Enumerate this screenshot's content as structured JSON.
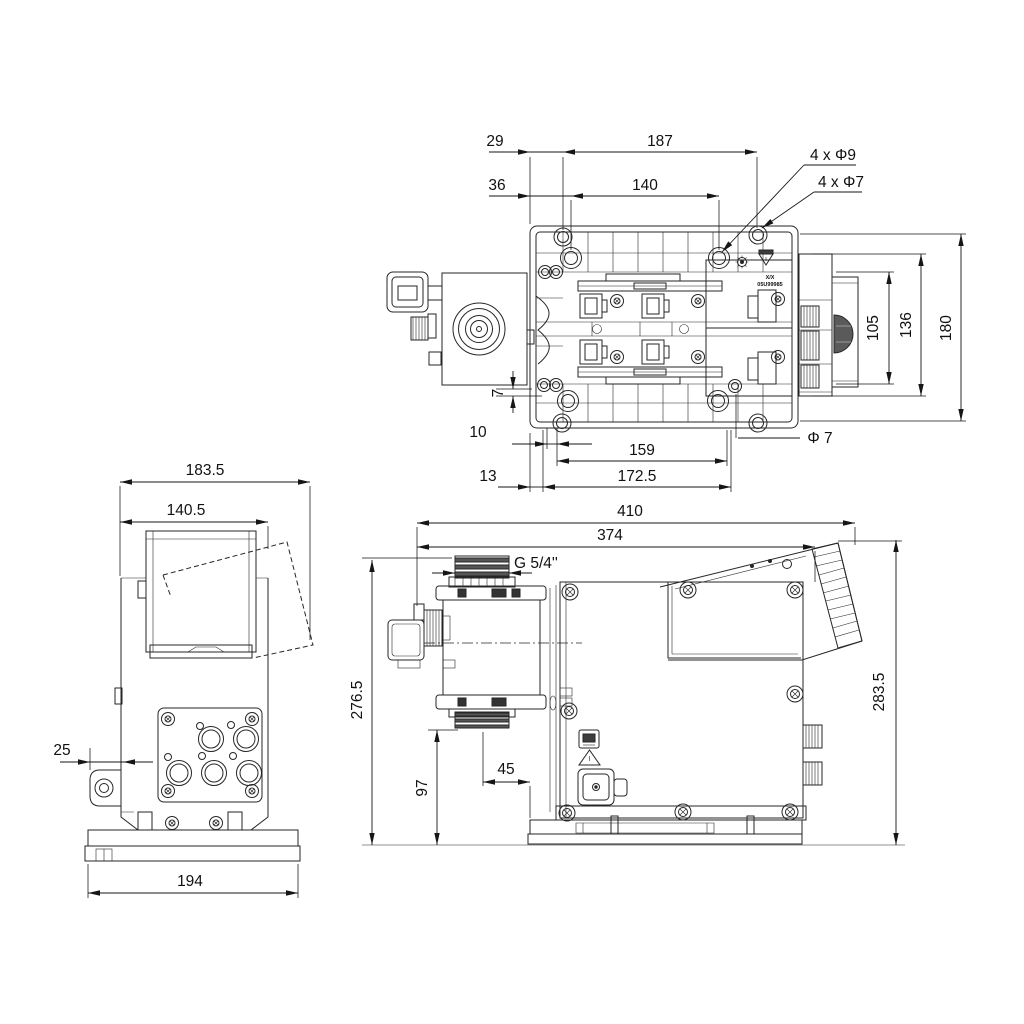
{
  "drawing_type": "pump dimensional drawing",
  "colors": {
    "line": "#262626",
    "background": "#ffffff",
    "text": "#111111"
  },
  "top_view": {
    "dim_29": "29",
    "dim_187": "187",
    "dim_36": "36",
    "dim_140": "140",
    "label_4x_d9": "4 x Φ9",
    "label_4x_d7": "4 x Φ7",
    "dim_105": "105",
    "dim_136": "136",
    "dim_180": "180",
    "dim_7": "7",
    "dim_10": "10",
    "dim_159": "159",
    "label_d7": "Φ 7",
    "dim_13": "13",
    "dim_172_5": "172.5",
    "plate_mark_line1": "X/X",
    "plate_mark_line2": "05U99985"
  },
  "front_view": {
    "dim_183_5": "183.5",
    "dim_140_5": "140.5",
    "dim_25": "25",
    "dim_194": "194"
  },
  "side_view": {
    "dim_410": "410",
    "dim_374": "374",
    "thread_label": "G 5/4''",
    "dim_276_5": "276.5",
    "dim_97": "97",
    "dim_45": "45",
    "dim_283_5": "283.5"
  }
}
